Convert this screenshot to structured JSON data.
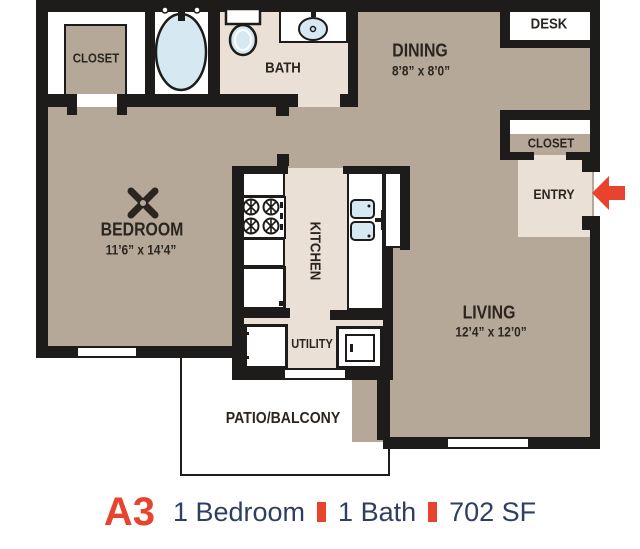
{
  "caption": {
    "code": "A3",
    "bedroom": "1 Bedroom",
    "bath": "1 Bath",
    "area": "702 SF"
  },
  "rooms": {
    "closet_top_left": {
      "label": "CLOSET"
    },
    "bath": {
      "label": "BATH"
    },
    "dining": {
      "label": "DINING",
      "dims": "8’8” x 8’0”"
    },
    "desk": {
      "label": "DESK"
    },
    "closet_entry": {
      "label": "CLOSET"
    },
    "entry": {
      "label": "ENTRY"
    },
    "bedroom": {
      "label": "BEDROOM",
      "dims": "11’6” x 14’4”"
    },
    "kitchen": {
      "label": "KITCHEN"
    },
    "utility": {
      "label": "UTILITY"
    },
    "living": {
      "label": "LIVING",
      "dims": "12’4” x 12’0”"
    },
    "patio": {
      "label": "PATIO/BALCONY"
    }
  },
  "icons": {
    "bathtub": "oval tub with faucet",
    "toilet": "tank and bowl",
    "bath_sink": "oval basin with faucet",
    "kitchen_sink": "double basin with faucet",
    "stove": "four spoked burners",
    "ceiling_fan": "x-blade fan",
    "entry_arrow": "red arrow pointing left into entry door"
  },
  "colors": {
    "accent_red": "#e8432e",
    "navy_text": "#2e3f63",
    "floor_tan": "#b5a899",
    "floor_cream": "#eae0d5",
    "fixture_blue": "#d6e8f2",
    "wall_black": "#1d1c1a"
  }
}
